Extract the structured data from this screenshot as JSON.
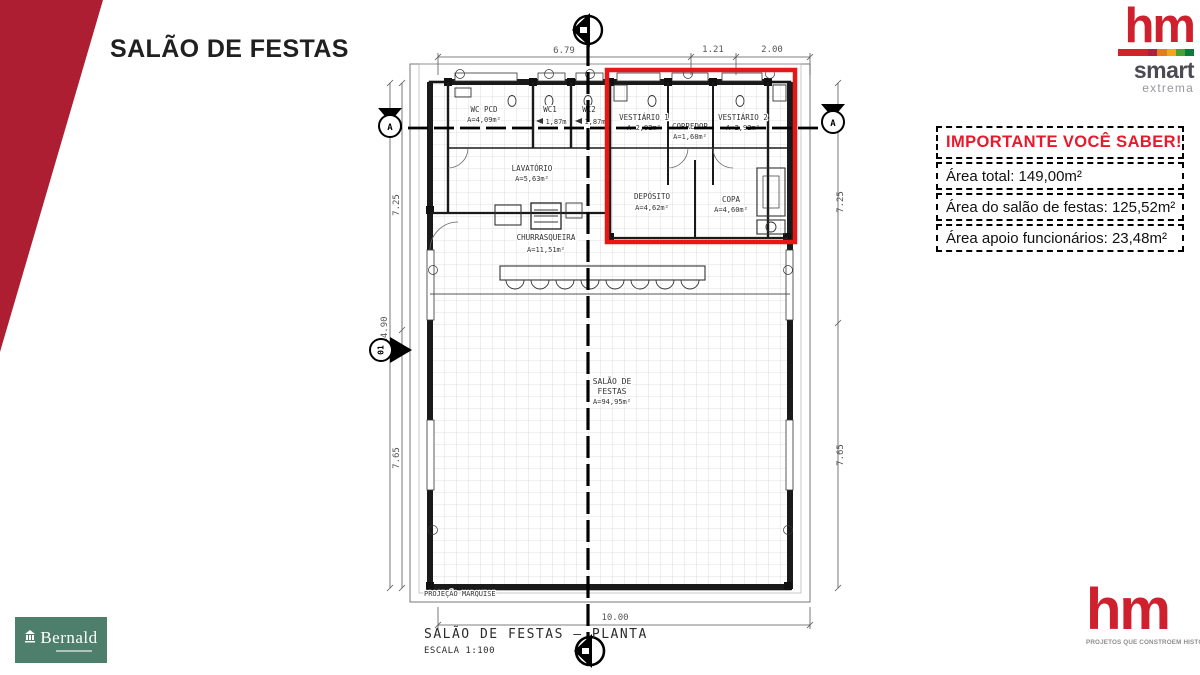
{
  "slide": {
    "title": "SALÃO DE FESTAS"
  },
  "colors": {
    "accent_wedge": "#ae1e32",
    "brand_red": "#cf202e",
    "highlight_red": "#e81717",
    "heading_red": "#e8192c",
    "bernald_green": "#4e7f6c"
  },
  "brand_top": {
    "wordmark": "hm",
    "line2": "smart",
    "line3": "extrema"
  },
  "brand_bottom": {
    "wordmark": "hm",
    "tagline": "PROJETOS QUE CONSTROEM HISTÓRIAS"
  },
  "partner_logo": {
    "name": "Bernald"
  },
  "info_panel": {
    "heading": "IMPORTANTE VOCÊ SABER!",
    "items": [
      "Área total: 149,00m²",
      "Área do salão de festas: 125,52m²",
      "Área apoio funcionários: 23,48m²"
    ]
  },
  "plan": {
    "caption_title": "SALÃO DE FESTAS – PLANTA",
    "caption_scale": "ESCALA 1:100",
    "marquise": "PROJEÇÃO MARQUISE",
    "rooms": {
      "wc_pcd": {
        "name": "WC PCD",
        "area": "A=4,09m²"
      },
      "wc1": {
        "name": "WC1",
        "area": "1,87m"
      },
      "wc2": {
        "name": "WC2",
        "area": "1,87m"
      },
      "vestiario1": {
        "name": "VESTIÁRIO 1",
        "area": "A=2,92m²"
      },
      "corredor": {
        "name": "CORREDOR",
        "area": "A=1,68m²"
      },
      "vestiario2": {
        "name": "VESTIÁRIO 2",
        "area": "A=2,92m²"
      },
      "lavatorio": {
        "name": "LAVATÓRIO",
        "area": "A=5,63m²"
      },
      "deposito": {
        "name": "DEPÓSITO",
        "area": "A=4,62m²"
      },
      "copa": {
        "name": "COPA",
        "area": "A=4,60m²"
      },
      "churrasqueira": {
        "name": "CHURRASQUEIRA",
        "area": "A=11,51m²"
      },
      "salao": {
        "name1": "SALÃO DE",
        "name2": "FESTAS",
        "area": "A=94,95m²"
      }
    },
    "dims": {
      "top": [
        "6.79",
        "1.21",
        "2.00"
      ],
      "left_total": "14.90",
      "left_upper": "7.25",
      "left_lower": "7.65",
      "right_upper": "7.25",
      "right_lower": "7.65",
      "bottom": "10.00"
    },
    "markers": {
      "left": "A",
      "right": "A",
      "detail": "01"
    }
  }
}
